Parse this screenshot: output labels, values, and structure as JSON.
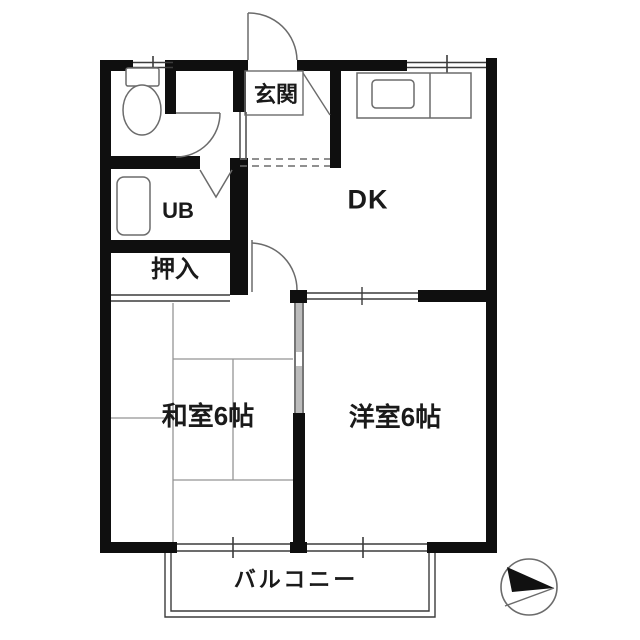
{
  "plan": {
    "labels": {
      "genkan": "玄関",
      "dk": "DK",
      "ub": "UB",
      "oshiire": "押入",
      "washitsu": "和室6帖",
      "yoshitsu": "洋室6帖",
      "balcony": "バルコニー"
    },
    "colors": {
      "wall": "#0f0f0f",
      "thin_line": "#3c3c3c",
      "fixture_line": "#6b6b6b",
      "tatami_line": "#949494",
      "text": "#1a1a1a",
      "background": "#ffffff",
      "sliding_door_fill": "#bcbcbc"
    }
  }
}
